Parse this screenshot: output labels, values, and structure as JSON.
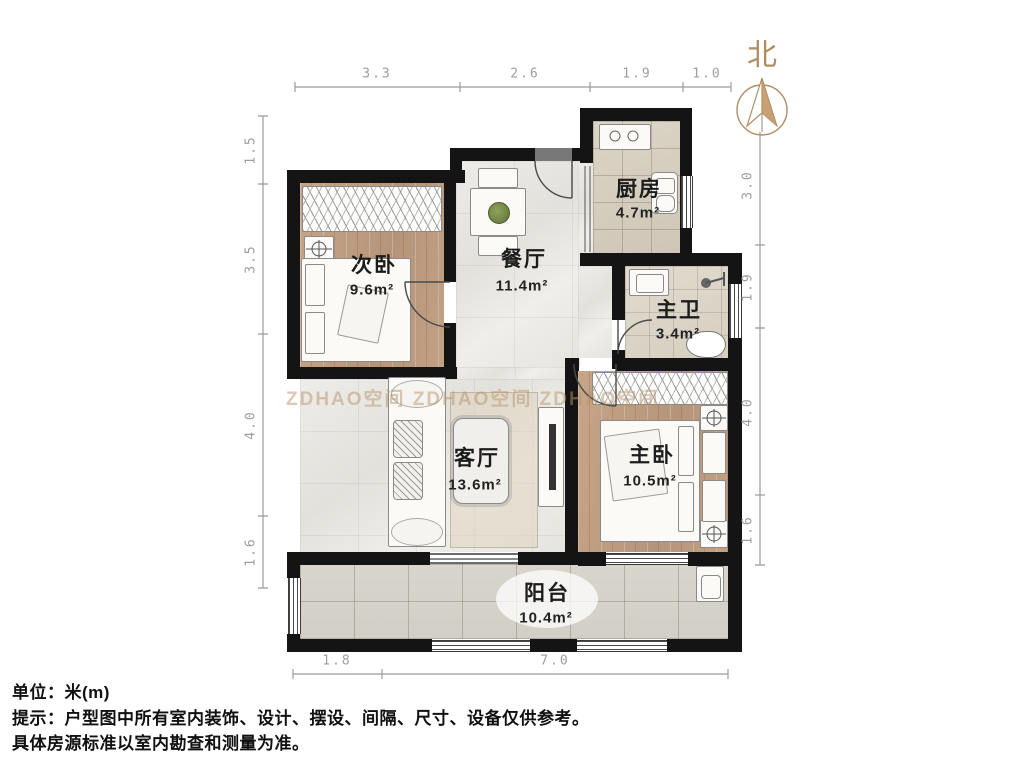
{
  "north_label": "北",
  "dimensions": {
    "top": [
      "3.3",
      "2.6",
      "1.9",
      "1.0"
    ],
    "left": [
      "1.5",
      "3.5",
      "4.0",
      "1.6"
    ],
    "right": [
      "3.0",
      "1.9",
      "4.0",
      "1.6"
    ],
    "bottom": [
      "1.8",
      "7.0"
    ]
  },
  "rooms": [
    {
      "name": "次卧",
      "area": "9.6m²"
    },
    {
      "name": "餐厅",
      "area": "11.4m²"
    },
    {
      "name": "厨房",
      "area": "4.7m²"
    },
    {
      "name": "主卫",
      "area": "3.4m²"
    },
    {
      "name": "客厅",
      "area": "13.6m²"
    },
    {
      "name": "主卧",
      "area": "10.5m²"
    },
    {
      "name": "阳台",
      "area": "10.4m²"
    }
  ],
  "footer": {
    "line1": "单位：米(m)",
    "line2": "提示：户型图中所有室内装饰、设计、摆设、间隔、尺寸、设备仅供参考。",
    "line3": "具体房源标准以室内勘查和测量为准。"
  },
  "watermark": "ZDHAO空间  ZDHAO空间  ZDHAO空间",
  "colors": {
    "wall": "#141414",
    "wood_floor": "#bf9e80",
    "marble_floor": "#e9e8e3",
    "accent_north": "#b08e63",
    "dimension_text": "#9e9e9e"
  }
}
